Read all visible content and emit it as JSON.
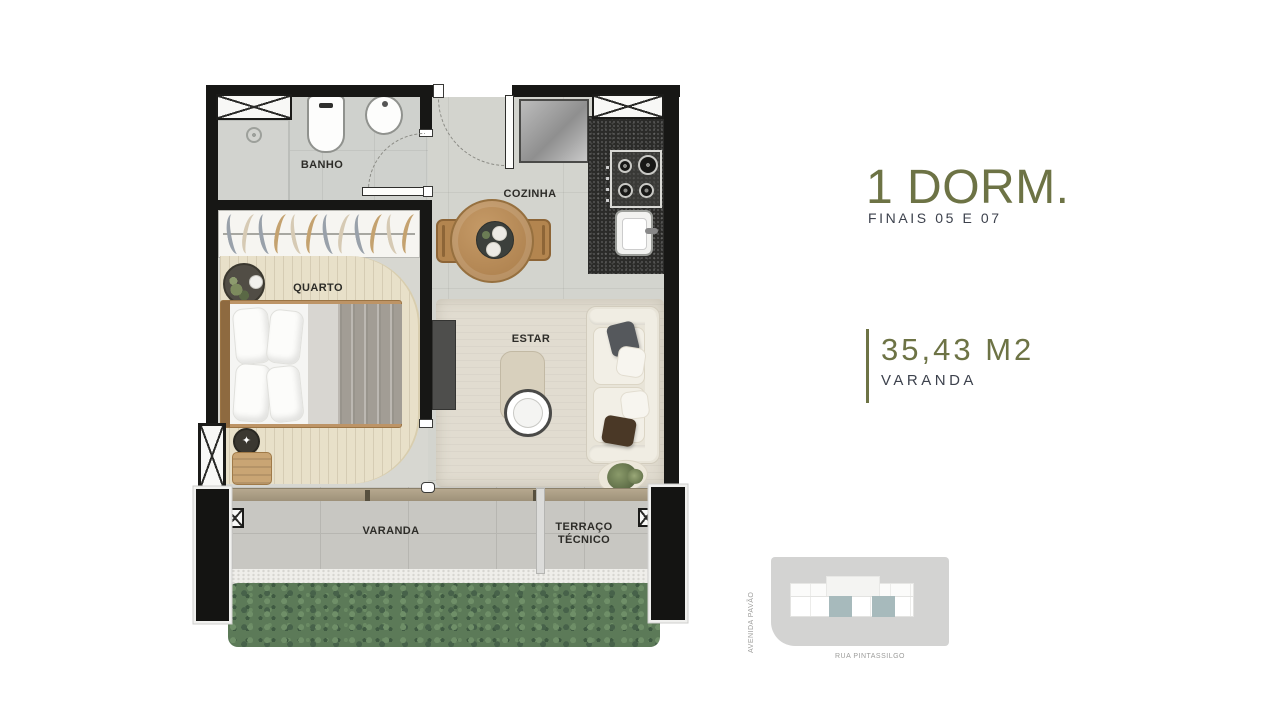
{
  "info_panel": {
    "title": "1 DORM.",
    "subtitle": "FINAIS 05 E 07",
    "area_value": "35,43 M2",
    "area_label": "VARANDA",
    "accent_color": "#6d7345",
    "text_color": "#3d424d"
  },
  "floor_plan": {
    "rooms": {
      "banho": "BANHO",
      "cozinha": "COZINHA",
      "quarto": "QUARTO",
      "estar": "ESTAR",
      "varanda": "VARANDA",
      "terraco_line1": "TERRAÇO",
      "terraco_line2": "TÉCNICO"
    },
    "icons": {
      "stool_star": "✦"
    }
  },
  "site_map": {
    "street_left": "AVENIDA PAVÃO",
    "street_bottom": "RUA PINTASSILGO",
    "highlight_color": "#a7babc",
    "site_color": "#d3d3d2"
  }
}
